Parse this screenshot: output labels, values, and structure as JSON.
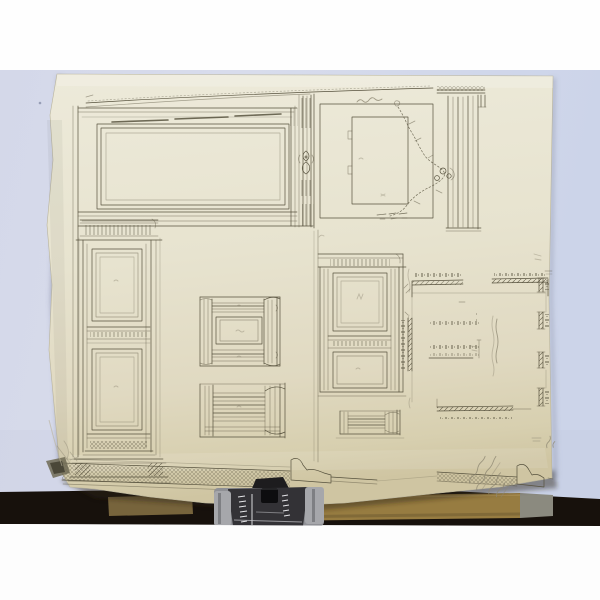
{
  "scene": {
    "subject": "photograph of an antique architectural drawing sheet (boiserie wall-panel details and room plan) standing on a dark easel with a metal document clip"
  },
  "colors": {
    "mat_white": "#fefefe",
    "backdrop_lavender": "#d4d9ea",
    "paper_light": "#edeada",
    "paper_dark": "#cfc5a2",
    "ink": "#57523e",
    "pencil": "#8e8873",
    "table_dark": "#17110c",
    "wood_tan": "#977c41",
    "clip_gray": "#a6a7ab",
    "clip_dark": "#333236"
  },
  "annotations": {
    "garland_panel_note": "illegible pencil note",
    "plan_center_note": "illegible pencil dimension notes",
    "bottom_right_inscription": "illegible handwritten inscription (pencil, diagonal)",
    "panel_center_marks": "illegible pencil reference marks"
  }
}
